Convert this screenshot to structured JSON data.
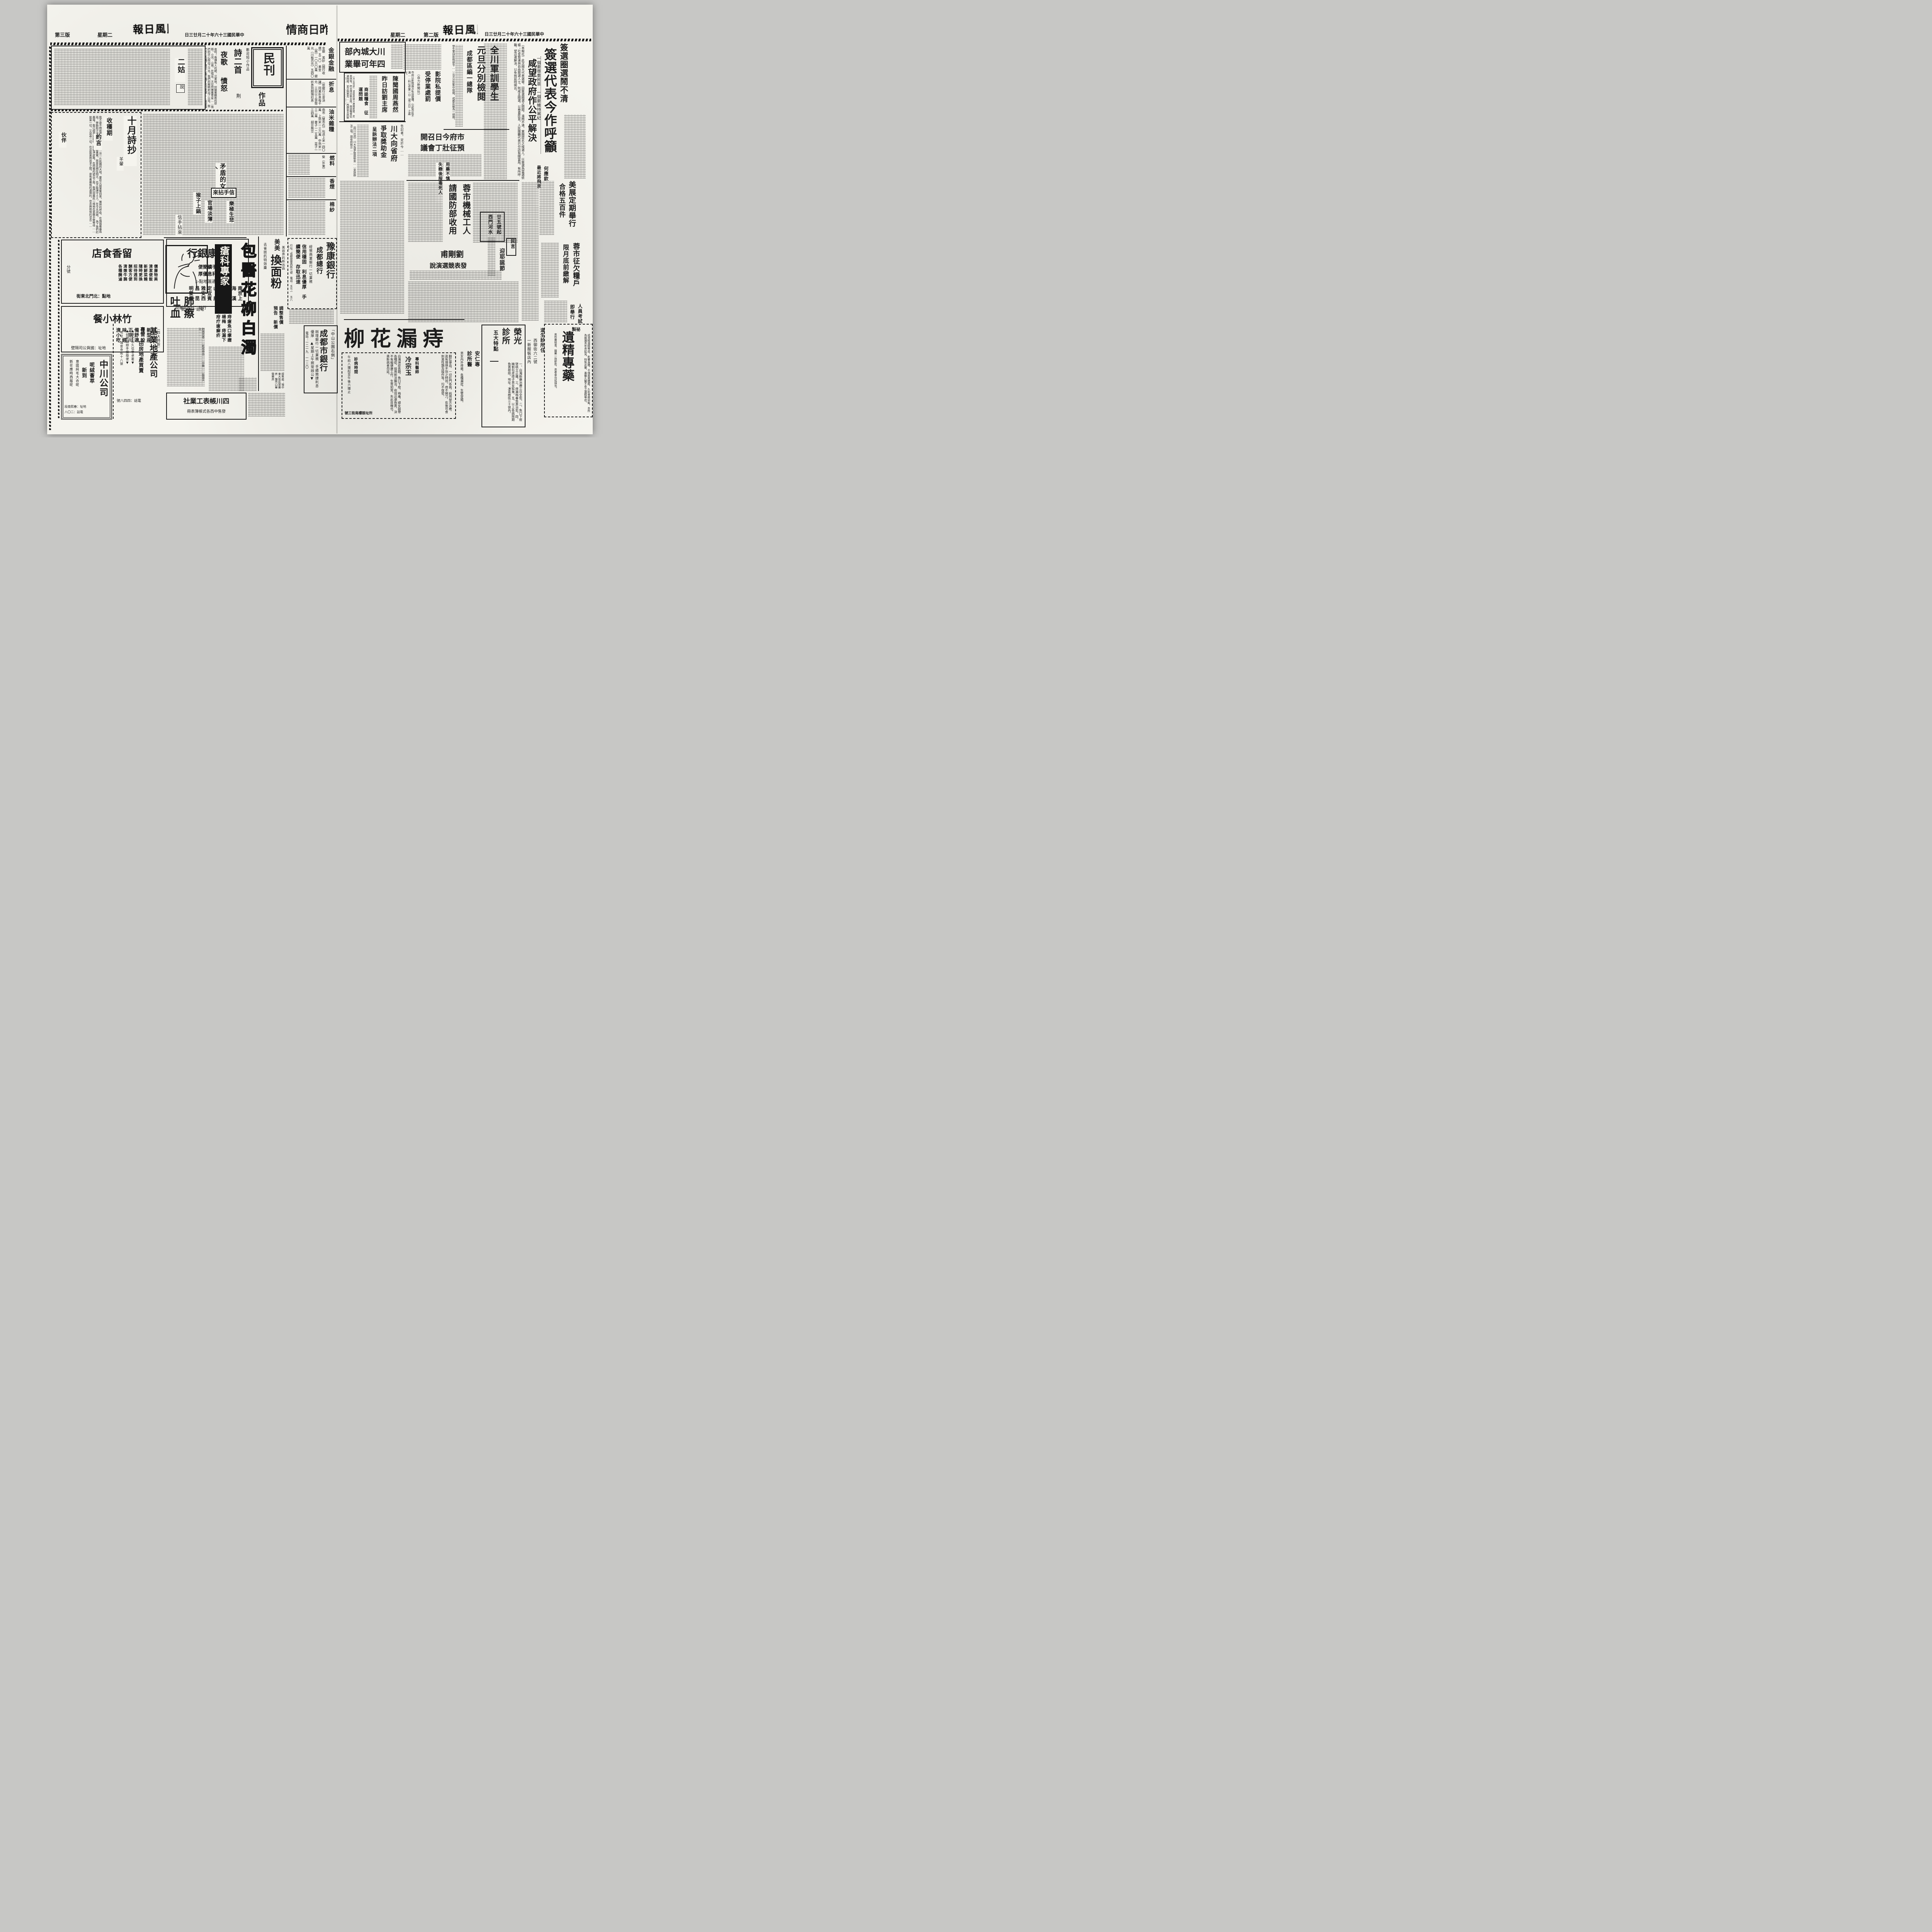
{
  "masthead": {
    "paper": "民風日報",
    "date": "中華民國三十六年十二月廿三日",
    "weekday": "星期二",
    "p2_label": "第二版",
    "p3_label": "第三版"
  },
  "market": {
    "header": "昨日商情",
    "rows": [
      {
        "label": "金銀金融",
        "text": "金銀　美鈔（國行收價）五二〇　黃金（兩）一〇六〇萬　銀元（川板百元）五四〇萬"
      },
      {
        "label": "折息",
        "text": "（依銀行公會決議）同業折息每千元　三日以上貨幣折息到期預扣息"
      },
      {
        "label": "油米雜糧",
        "text": "南市（雙市石）包送上米一四〇萬　上熟米一三六萬　中熟米一三二萬　麥子一二五萬　菜子一三四萬　胡豆無交"
      },
      {
        "label": "燃料",
        "text": "柴（外東）"
      },
      {
        "label": "香煙",
        "text": ""
      },
      {
        "label": "棉紗",
        "text": ""
      }
    ]
  },
  "p2": {
    "lead": {
      "kicker": "簽選圈選鬧不清",
      "headline": "簽選代表今作呼籲",
      "sub": "一個要尊重民意　一個要維持黨紀",
      "deck": "咸望政府作公平解決",
      "body": "（本報社）此次國大代表選舉，因簽選圈選之問題，淆鬧不清。黨團提名之候選人，以簽選為當選依據；社會賢達與自由競選人士，則咸主圈選，以尊重民意。人民團體代表已分訪有關當局，有所呼籲，望迅速解決，以免拖延時間云。"
    },
    "heyingqin": {
      "a": "何應欽",
      "b": "最近將飛京"
    },
    "quanchuan": {
      "l1": "全川軍訓學生",
      "l2": "元旦分別檢閱",
      "l3": "成都區編一總隊",
      "body": "學生軍訓依照部令……元旦分別集中檢閱，成都區編為一總隊。"
    },
    "chuanda_grad": {
      "l1": "川大城內部",
      "l2": "四年可畢業"
    },
    "chen": {
      "l1": "陳聞國周燕然",
      "l2": "昨日訪劉主席",
      "kicker": "商談糧食　征運問題",
      "body": "（大公社訊）渝區高級人員陳開國、周燕然等，昨日拜訪劉主席，商談糧食征運問題，並交換意見……西康省主席劉文輝氏……本年度征賦云。"
    },
    "yingyuan": {
      "l1": "影院私提價",
      "l2": "受停業處罰",
      "tag": "（自力新聞社）",
      "body": "市府以影院兩次私自提價，引起市民不滿……科以停業一日（或二日）之處分。"
    },
    "chuanda_funds": {
      "kicker": "告記者，定於今……",
      "l1": "川大向省府",
      "l2": "爭取獎助金",
      "l3": "呈訴辦法二項",
      "body": "（四川社訊）川大為爭取獎助金……呈訴辦法二項，請省府核示……"
    },
    "shifu": {
      "l1": "市府今日召開",
      "l2": "預征壯丁會議"
    },
    "gongren": {
      "l1": "蓉市機械工人",
      "l2": "請國防部收用"
    },
    "liu": {
      "l1": "劉剛甫",
      "l2": "發表競選演說"
    },
    "shilian": {
      "a": "用藥不慎",
      "b": "失戀後服毒死人"
    },
    "meizhan": {
      "l1": "美展定期舉行",
      "l2": "合格五百件"
    },
    "qianliang": {
      "l1": "蓉市征欠糧戶",
      "l2": "限月底前繳解"
    },
    "kaoshi": {
      "a": "人員考試",
      "b": "即舉行"
    },
    "ershiwu": {
      "a": "廿五號起",
      "b": "西門河水"
    },
    "minyan": {
      "label": "民言",
      "title": "迎耶誕節"
    },
    "ads": {
      "anren": {
        "big_title": "痔漏花柳",
        "right": "翻肛便血，一切肛門各病，純用祕方治療，眞有理想不到之特效。痔不開刀，愈後可食刺激性類及操作等，均不復發。",
        "doc_label": "專科醫師",
        "doctor": "冷宗玉",
        "mid": "白濁淋症各期，魚口下疳，梅毒，婦女崩帶各種症，採用新法醫治，收效迅速負責，決不有礙健康工作，生育如常。失此良機也，患斯病者勿延。",
        "hours_label": "診病時間",
        "hours": "午前八鐘起至午後六鐘止",
        "addr": "所址鼓樓南街三號",
        "c1": "安仁專",
        "c2": "診所醫",
        "items": "男女內外痔瘡，各種漏症，生管穿腸。"
      },
      "rongguang": {
        "t1": "榮光",
        "t2": "診所",
        "tag": "五大特點",
        "points": "一、白濁新藥治療三日全愈。二、魚口下疳墜桃立止痛。三、痔漏梅毒負責治愈。四、精割包皮痔子男女狐臭。五、以上各病限期負責根除。地址：凍青樹街三十號內。"
      },
      "daosheng": {
        "l1": "道生診所住",
        "l2": "西御街六二號",
        "l3": "一新服裝店內"
      },
      "yijing": {
        "tag": "祕製",
        "title": "遺精專藥",
        "r": "成滑精漏精等症，影響身體，不僅面黃體瘦，久則骨瘦如柴。本所為維護青年界起見，特製此藥，專醫久醫不愈之遺精等症。",
        "l": "來所費檢查，服藥一劑即愈，患者幸勿延誤也。"
      }
    }
  },
  "p3": {
    "novel": {
      "title": "二姑",
      "tag": "說"
    },
    "supplement": {
      "seal": "民刊",
      "works": "作品",
      "welcome": "歡迎短小作品"
    },
    "poems2": {
      "header": "詩二首",
      "author": "荆",
      "t1": "夜歌",
      "t2": "憤怒",
      "body": "夜呵！像捕魚人的網，沉重地，封鎖著戰敗的原野。小河，山崗，在喘息，天空閃爍著寒星……我們的手心揑出了汗水，我們的眼睛射出了火花，我們的心充滿了憤怒；像打滿了氣的皮球……將是燦爛的明天。"
    },
    "october": {
      "header": "十月詩抄",
      "author": "羊翬",
      "p1": "收穫期",
      "p2": "約言",
      "p3": "伙伴",
      "body": "我不是不問收穫的耕耘者……這一片飢餓的大地，要從火燄里奪回來。熾熱的呼吸，在煽揚著暴風雨，勞動和汗液，都為了換取果實。就是花開在明天，也不能讓守土人，在今天凋謝。　為了我們的農場，我已經束好腰帶，刷乾淨皮靴，在閃電的號召下面，我們同農民一樣地在張開手臂等待……拋棄一切，又追尋一切，在這拋棄與追求之間，是有着嚴格的選擇的，信念與熱情的混合……"
    },
    "woman": {
      "title": "矛盾的女人"
    },
    "pickups": {
      "header": "信手拈來",
      "i1": "樂極生悲",
      "i2": "官場淡薄",
      "i3": "猴子上鍋",
      "again": "信手拈來"
    },
    "ads": {
      "liuxiang": {
        "title": "留香食店",
        "features": "價廉物美　清潔便飯　新鮮菜餚　隨時更換　招待週到　酬客方便　清燉牛腩　各種醃滷",
        "branch": "分號",
        "addr": "地點：北門北東街"
      },
      "jikang": {
        "title": "濟康銀行",
        "s1": "手續簡便",
        "s2": "利息優厚",
        "remit": "◁通滙地點▷",
        "cities": "南京上海　漢口重慶　內江樂山　康定宜賓　雅安西昌　昆明滎經",
        "addr": "行址：成都北新街",
        "phone": "電話：八九號"
      },
      "zhulin": {
        "title": "竹林小餐",
        "tag": "（四大特設）",
        "features": "新型座位　設備舒適　正宗川味　經濟小吃",
        "addr": "地址：國貨公司隔壁"
      },
      "zhongchuan": {
        "title": "中川公司",
        "l1": "呢絨薈萃",
        "l2": "新到",
        "l3": "意國純毛大衣呢",
        "l4": "新花應時西服呢",
        "addr": "地址：春熙南段",
        "phone": "電話：二〇八"
      },
      "jiye": {
        "title": "基業地產公司",
        "tag": "專營",
        "biz": "田房地產買賣",
        "s1": "▲歷史攸久信譽卓著▼",
        "s2": "▲如蒙賜辦手續簡便▼",
        "addr": "地址：海會寺街十八號",
        "phone": "電話：四四八號"
      },
      "chuangke": {
        "title": "瘡科專家",
        "items": "痔瘡魚口瘰癧楊梅　痔漏下疳疔瘡癬疥"
      },
      "feizhai": {
        "title": "肺瘵吐血",
        "body": "肺病患者……乾咳帶血……中醫……能當天治……"
      },
      "baoyi": {
        "title": "包醫花柳白濁"
      },
      "meimei": {
        "kicker": "美容界的新出品",
        "brand": "美美",
        "title": "換面粉",
        "left": "去雀斑的特效藥",
        "notice": "調整售價　預告　新價",
        "sellers": "經售處：場中東大街民眾藥房　鹽市口華榮藥房"
      },
      "yukang": {
        "title": "豫康銀行",
        "sub": "成都總行",
        "biz": "經營商業銀行一切業務",
        "slogans": "信用穩固　利息優厚　手續簡便　存取迅速",
        "addr_phone": "行址：成都提督西街七號　電話：五七一　五八九五"
      },
      "shiyin": {
        "bracket": "「中山公園右側」",
        "title": "成都市銀行",
        "lines": "辦理銀行一切業務　手續簡捷利息優厚　▲星期上午照常辦公▼",
        "phone": "電話：一二一九　一一二〇"
      },
      "zhangbiao": {
        "title": "四川帳表工業社",
        "sub": "發售中西各式帳簿表冊"
      }
    }
  }
}
